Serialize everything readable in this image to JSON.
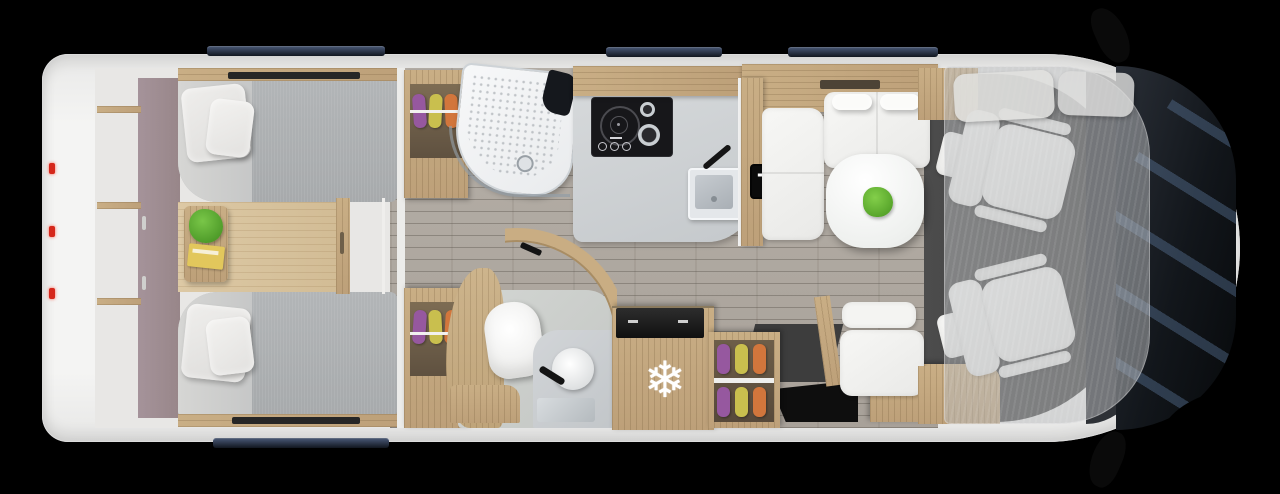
{
  "scene": {
    "kind": "motorhome-floorplan-overhead-render",
    "background": "#000000"
  },
  "labels": {
    "tv": "TV"
  },
  "icons": {
    "fridge_freezer": {
      "name": "snowflake-icon",
      "glyph": "❄"
    }
  },
  "colors": {
    "body_white": "#f4f4f3",
    "floor_planks_grey": "#b0aaa2",
    "bedroom_floor_wood": "#d8c39e",
    "cabinet_wood": "#c4a881",
    "mattress_grey": "#adb0b2",
    "pillow_white": "#e9e8e6",
    "headboard_mauve": "#a08e91",
    "kitchen_counter": "#ced1d4",
    "hob_black": "#17171a",
    "sink_steel": "#b9bfc4",
    "tv_background": "#0b0b0b",
    "tv_text": "#ffffff",
    "table_white": "#f8f8f6",
    "plant_green": "#5cab31",
    "clothes_purple": "#96589f",
    "clothes_yellow": "#c9bf4e",
    "clothes_orange": "#d2763c",
    "window_glass": "#1c2433",
    "windshield_dark": "#0f1216",
    "cab_floor_grey": "#454545",
    "drop_down_bed_grey": "#bcbec0",
    "tail_light_red": "#d5271b",
    "snowflake_white": "#ffffff"
  },
  "areas": {
    "rear_bedroom": [
      "rear-storage-shelves",
      "twin-bed-top",
      "twin-bed-bottom",
      "bedside-table",
      "plant",
      "book",
      "bed-step-drawers"
    ],
    "washroom": [
      "wardrobe-top",
      "wardrobe-bottom",
      "shower",
      "toilet",
      "washbasin",
      "curved-door"
    ],
    "kitchen": [
      "counter",
      "hob",
      "sink",
      "fridge-freezer"
    ],
    "lounge": [
      "tv",
      "dinette-sofa",
      "dinette-table",
      "travel-seat",
      "shoe-rack",
      "entry-step"
    ],
    "cab": [
      "driver-seat",
      "passenger-seat",
      "drop-down-bed",
      "windshield",
      "side-mirrors"
    ]
  }
}
